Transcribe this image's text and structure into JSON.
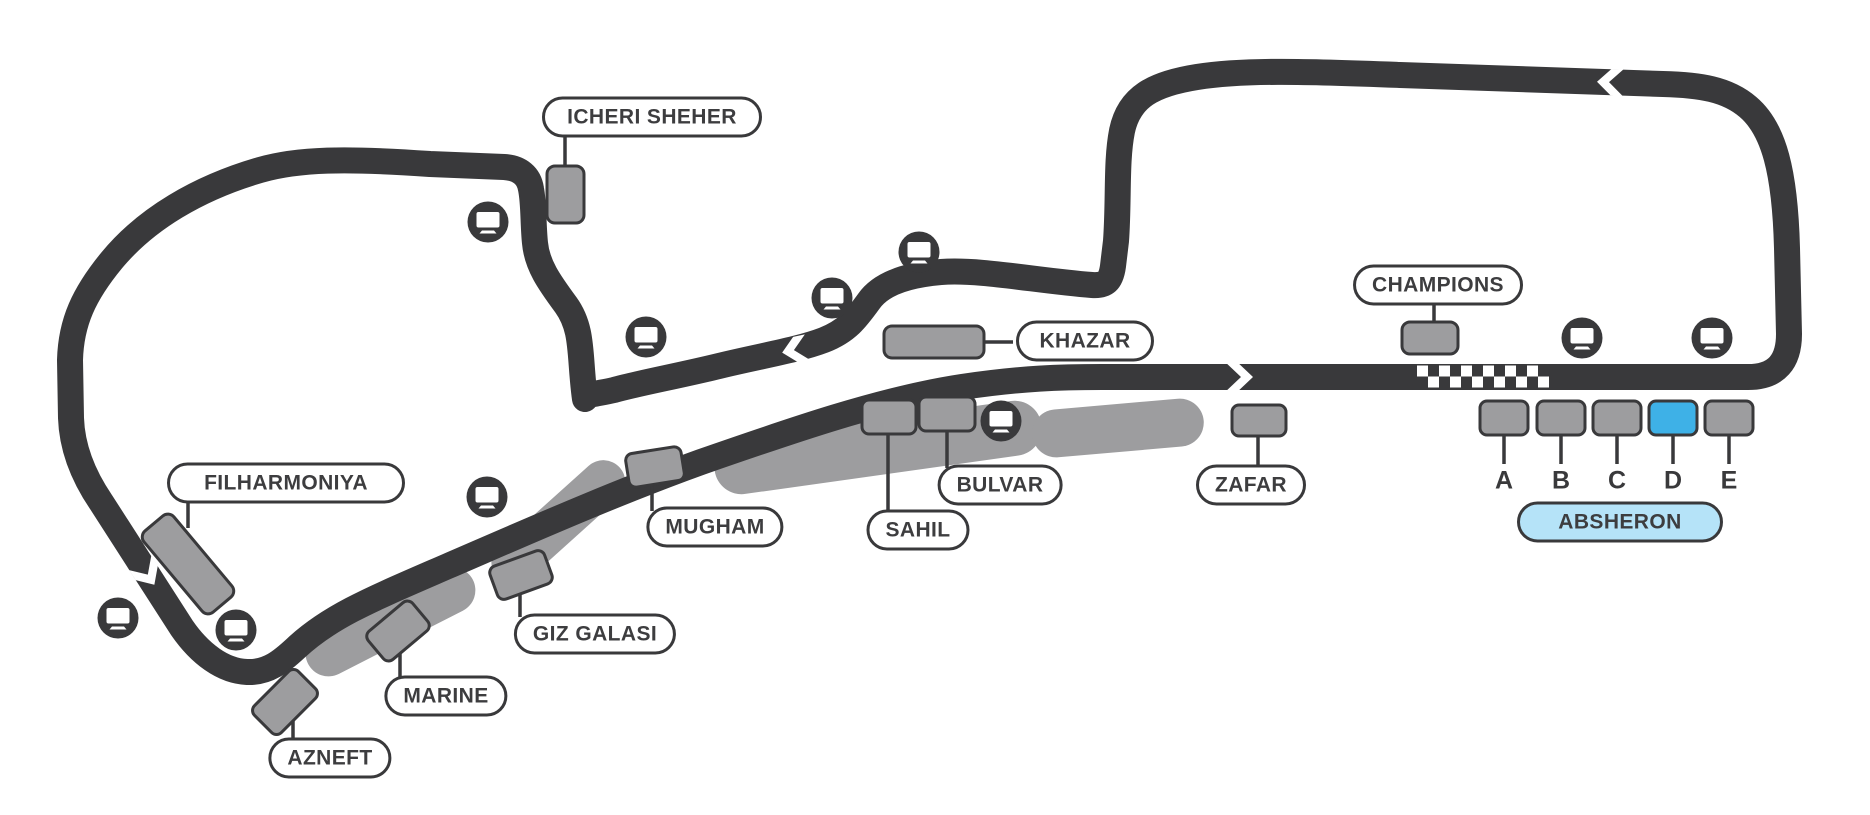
{
  "colors": {
    "track": "#39393b",
    "stand_fill": "#9d9d9f",
    "stand_border": "#39393b",
    "selected_section_fill": "#3eb1e7",
    "absheron_pill_fill": "#b5e3f8",
    "park_blob": "#9d9d9f",
    "background": "#ffffff"
  },
  "labels": {
    "icheri_sheher": "ICHERI SHEHER",
    "khazar": "KHAZAR",
    "champions": "CHAMPIONS",
    "zafar": "ZAFAR",
    "bulvar": "BULVAR",
    "sahil": "SAHIL",
    "mugham": "MUGHAM",
    "giz_galasi": "GIZ GALASI",
    "marine": "MARINE",
    "azneft": "AZNEFT",
    "filharmoniya": "FILHARMONIYA",
    "absheron": "ABSHERON"
  },
  "absheron_sections": {
    "items": [
      {
        "label": "A",
        "selected": false
      },
      {
        "label": "B",
        "selected": false
      },
      {
        "label": "C",
        "selected": false
      },
      {
        "label": "D",
        "selected": true
      },
      {
        "label": "E",
        "selected": false
      }
    ],
    "selected_section": "D"
  },
  "icons": {
    "screen": "tv-screen-icon",
    "screen_count": 10
  },
  "track": {
    "start_finish": "checkered-line",
    "direction_arrows": 4
  }
}
